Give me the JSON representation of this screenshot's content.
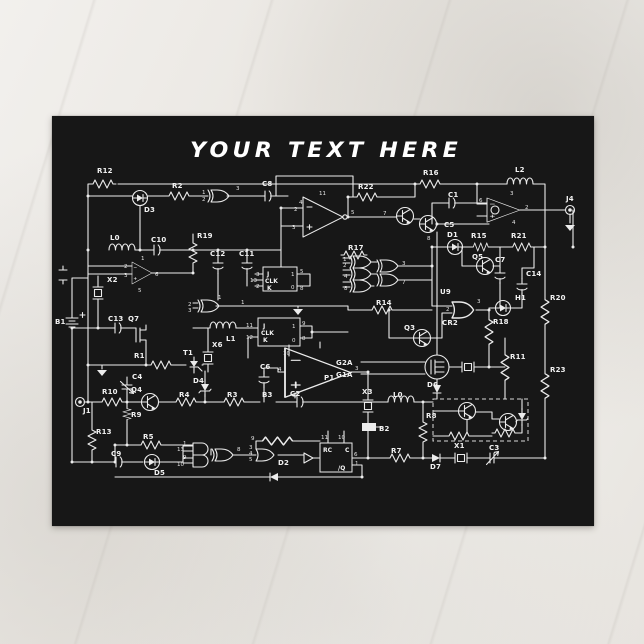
{
  "postcard": {
    "title": "YOUR TEXT HERE",
    "colors": {
      "card_bg": "#171717",
      "line": "#ececec",
      "page_bg": "#eceae6"
    }
  },
  "labels": {
    "R12": "R12",
    "R2": "R2",
    "C8": "C8",
    "R22": "R22",
    "R16": "R16",
    "L2": "L2",
    "C1": "C1",
    "J4": "J4",
    "D3": "D3",
    "L0a": "L0",
    "C10": "C10",
    "R19": "R19",
    "C12": "C12",
    "C11": "C11",
    "R17": "R17",
    "C5": "C5",
    "D1": "D1",
    "R15": "R15",
    "R21": "R21",
    "Q5": "Q5",
    "C7": "C7",
    "C14": "C14",
    "X2": "X2",
    "B1": "B1",
    "C13": "C13",
    "Q7": "Q7",
    "U9": "U9",
    "CR2": "CR2",
    "H1": "H1",
    "R20": "R20",
    "R18": "R18",
    "R14": "R14",
    "Q3": "Q3",
    "R11": "R11",
    "R23": "R23",
    "G2A": "G2A",
    "G1A": "G1A",
    "D6": "D6",
    "R1": "R1",
    "T1": "T1",
    "X6": "X6",
    "L1": "L1",
    "D4": "D4",
    "C6": "C6",
    "P1": "P1",
    "C4": "C4",
    "Q4": "Q4",
    "R10": "R10",
    "J1": "J1",
    "R9": "R9",
    "R4": "R4",
    "R3": "R3",
    "B3": "B3",
    "C2": "C2",
    "X3": "X3",
    "L0b": "L0",
    "B2": "B2",
    "R8": "R8",
    "X1": "X1",
    "R13": "R13",
    "R5": "R5",
    "C9": "C9",
    "D5": "D5",
    "D2": "D2",
    "R7": "R7",
    "D7": "D7",
    "C3": "C3"
  },
  "boxes": {
    "j": "J",
    "clk": "CLK",
    "k": "K",
    "rc": "RC",
    "c": "C",
    "qbar": "/Q"
  },
  "pins": {
    "n0": "0",
    "n1": "1",
    "n2": "2",
    "n3": "3",
    "n4": "4",
    "n5": "5",
    "n6": "6",
    "n7": "7",
    "n8": "8",
    "n9": "9",
    "n10": "10",
    "n11": "11",
    "n12": "12",
    "n13": "13"
  }
}
